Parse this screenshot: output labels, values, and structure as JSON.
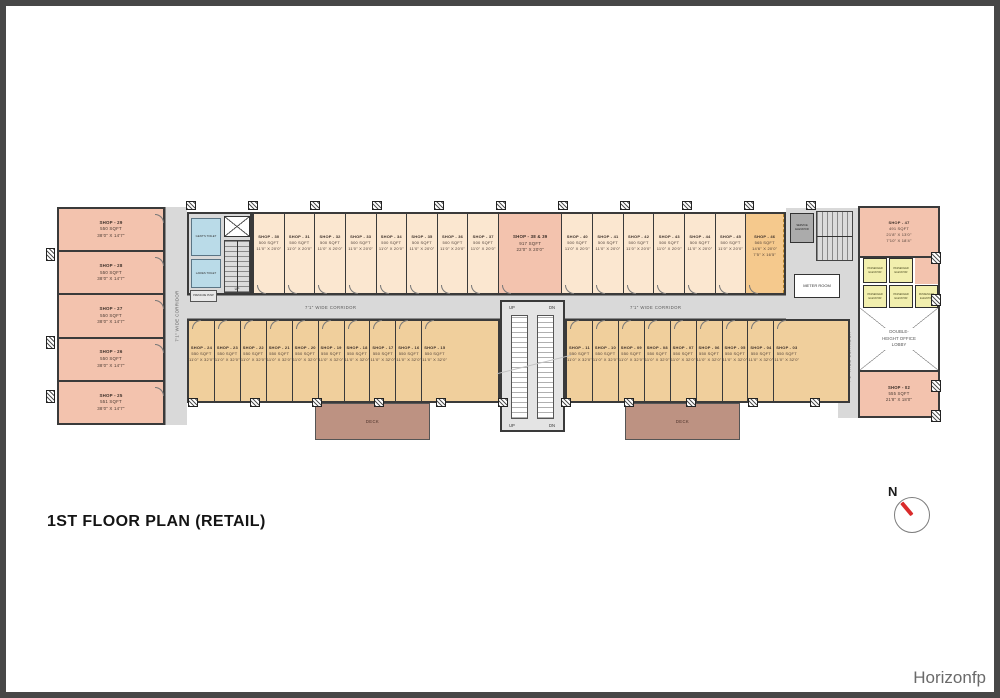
{
  "title": "1ST FLOOR PLAN (RETAIL)",
  "watermark": "Horizonfp",
  "north_label": "N",
  "labels": {
    "corridor": "7'1\" WIDE CORRIDOR",
    "deck": "DECK",
    "office_lobby": "DOUBLE-HEIGHT OFFICE LOBBY",
    "passenger_elevator": "PASSENGER ELEVATOR",
    "service_elevator": "SERVICE ELEVATOR",
    "meter_room": "METER ROOM",
    "gents_toilet": "GENT'S TOILET",
    "ladies_toilet": "LADIES TOILET",
    "pump_room": "PRESSURE PUMP",
    "up": "UP",
    "dn": "DN"
  },
  "colors": {
    "salmon": "#f3c3ae",
    "peach": "#fbe7d0",
    "tan": "#f0cf9c",
    "orange46": "#f5c98d",
    "corridor": "#d9d9d9",
    "deck": "#bd9282",
    "toilet": "#badbe8",
    "elev": "#f2efae",
    "wall": "#3a3a3a"
  },
  "left_wing_shops": [
    {
      "name": "SHOP - 29",
      "area": "550 SQFT",
      "dims": "38'0\" X 14'7\""
    },
    {
      "name": "SHOP - 28",
      "area": "550 SQFT",
      "dims": "38'0\" X 14'7\""
    },
    {
      "name": "SHOP - 27",
      "area": "550 SQFT",
      "dims": "38'0\" X 14'7\""
    },
    {
      "name": "SHOP - 26",
      "area": "550 SQFT",
      "dims": "38'0\" X 14'7\""
    },
    {
      "name": "SHOP - 25",
      "area": "551 SQFT",
      "dims": "38'0\" X 14'7\""
    }
  ],
  "top_row": {
    "shops_a": [
      {
        "name": "SHOP - 30",
        "area": "500 SQFT",
        "dims": "11'0\" X 20'0\""
      },
      {
        "name": "SHOP - 31",
        "area": "500 SQFT",
        "dims": "11'0\" X 20'0\""
      },
      {
        "name": "SHOP - 32",
        "area": "500 SQFT",
        "dims": "11'0\" X 20'0\""
      },
      {
        "name": "SHOP - 33",
        "area": "500 SQFT",
        "dims": "11'0\" X 20'0\""
      },
      {
        "name": "SHOP - 34",
        "area": "500 SQFT",
        "dims": "11'0\" X 20'0\""
      },
      {
        "name": "SHOP - 35",
        "area": "500 SQFT",
        "dims": "11'0\" X 20'0\""
      },
      {
        "name": "SHOP - 36",
        "area": "500 SQFT",
        "dims": "11'0\" X 20'0\""
      },
      {
        "name": "SHOP - 37",
        "area": "500 SQFT",
        "dims": "11'0\" X 20'0\""
      }
    ],
    "big_shop": {
      "name": "SHOP - 38 & 39",
      "area": "917 SQFT",
      "dims": "22'0\" X 20'0\""
    },
    "shops_b": [
      {
        "name": "SHOP - 40",
        "area": "500 SQFT",
        "dims": "11'0\" X 20'0\""
      },
      {
        "name": "SHOP - 41",
        "area": "500 SQFT",
        "dims": "11'0\" X 20'0\""
      },
      {
        "name": "SHOP - 42",
        "area": "500 SQFT",
        "dims": "11'0\" X 20'0\""
      },
      {
        "name": "SHOP - 43",
        "area": "500 SQFT",
        "dims": "11'0\" X 20'0\""
      },
      {
        "name": "SHOP - 44",
        "area": "500 SQFT",
        "dims": "11'0\" X 20'0\""
      },
      {
        "name": "SHOP - 45",
        "area": "500 SQFT",
        "dims": "11'0\" X 20'0\""
      }
    ],
    "corner_shop": {
      "name": "SHOP - 46",
      "area": "565 SQFT",
      "dims": "14'6\" X 20'0\"",
      "dims2": "7'5\" X 16'5\""
    }
  },
  "bottom_row": {
    "left_shops": [
      {
        "name": "SHOP - 24",
        "area": "550 SQFT",
        "dims": "11'0\" X 32'0\""
      },
      {
        "name": "SHOP - 23",
        "area": "550 SQFT",
        "dims": "11'0\" X 32'0\""
      },
      {
        "name": "SHOP - 22",
        "area": "550 SQFT",
        "dims": "11'0\" X 32'0\""
      },
      {
        "name": "SHOP - 21",
        "area": "550 SQFT",
        "dims": "11'0\" X 32'0\""
      },
      {
        "name": "SHOP - 20",
        "area": "550 SQFT",
        "dims": "11'0\" X 32'0\""
      },
      {
        "name": "SHOP - 19",
        "area": "550 SQFT",
        "dims": "11'0\" X 32'0\""
      },
      {
        "name": "SHOP - 18",
        "area": "550 SQFT",
        "dims": "11'0\" X 32'0\""
      },
      {
        "name": "SHOP - 17",
        "area": "550 SQFT",
        "dims": "11'0\" X 32'0\""
      },
      {
        "name": "SHOP - 16",
        "area": "550 SQFT",
        "dims": "11'0\" X 32'0\""
      },
      {
        "name": "SHOP - 15",
        "area": "550 SQFT",
        "dims": "11'0\" X 32'0\""
      }
    ],
    "right_shops": [
      {
        "name": "SHOP - 11",
        "area": "550 SQFT",
        "dims": "11'0\" X 32'0\""
      },
      {
        "name": "SHOP - 10",
        "area": "550 SQFT",
        "dims": "11'0\" X 32'0\""
      },
      {
        "name": "SHOP - 09",
        "area": "550 SQFT",
        "dims": "11'0\" X 32'0\""
      },
      {
        "name": "SHOP - 08",
        "area": "550 SQFT",
        "dims": "11'0\" X 32'0\""
      },
      {
        "name": "SHOP - 07",
        "area": "550 SQFT",
        "dims": "11'0\" X 32'0\""
      },
      {
        "name": "SHOP - 06",
        "area": "550 SQFT",
        "dims": "11'0\" X 32'0\""
      },
      {
        "name": "SHOP - 05",
        "area": "550 SQFT",
        "dims": "11'0\" X 32'0\""
      },
      {
        "name": "SHOP - 04",
        "area": "550 SQFT",
        "dims": "11'0\" X 32'0\""
      },
      {
        "name": "SHOP - 03",
        "area": "550 SQFT",
        "dims": "11'0\" X 32'0\""
      }
    ]
  },
  "right_block": {
    "shop47": {
      "name": "SHOP - 47",
      "area": "491 SQFT",
      "dims": "21'8\" X 13'0\"",
      "dims2": "7'10\" X 18'4\""
    },
    "shop02": {
      "name": "SHOP - 02",
      "area": "555 SQFT",
      "dims": "21'8\" X 18'0\""
    }
  }
}
